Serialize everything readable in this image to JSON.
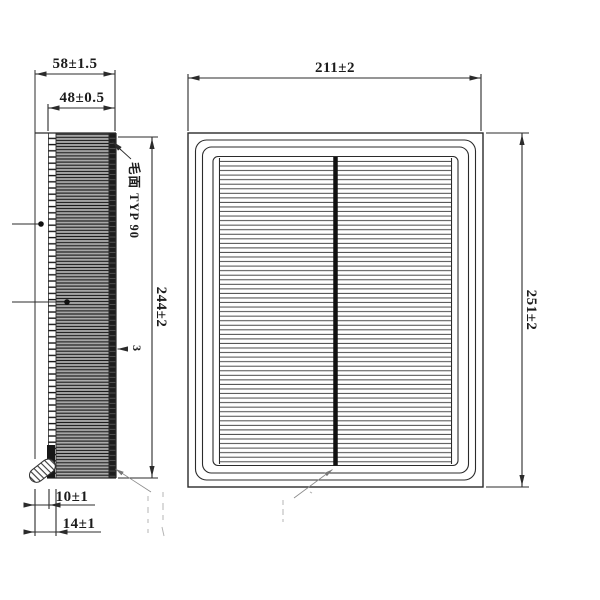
{
  "drawing": {
    "ink_color": "#2b2b2b",
    "side_view": {
      "dim_depth_total": "58±1.5",
      "dim_depth_pleats": "48±0.5",
      "dim_height": "244±2",
      "surface_note": "毛面 TYP 90",
      "pleat_pitch_label": "3",
      "dim_seal_lip": "10±1",
      "dim_seal_base": "14±1"
    },
    "front_view": {
      "dim_width": "211±2",
      "dim_height": "251±2"
    }
  }
}
